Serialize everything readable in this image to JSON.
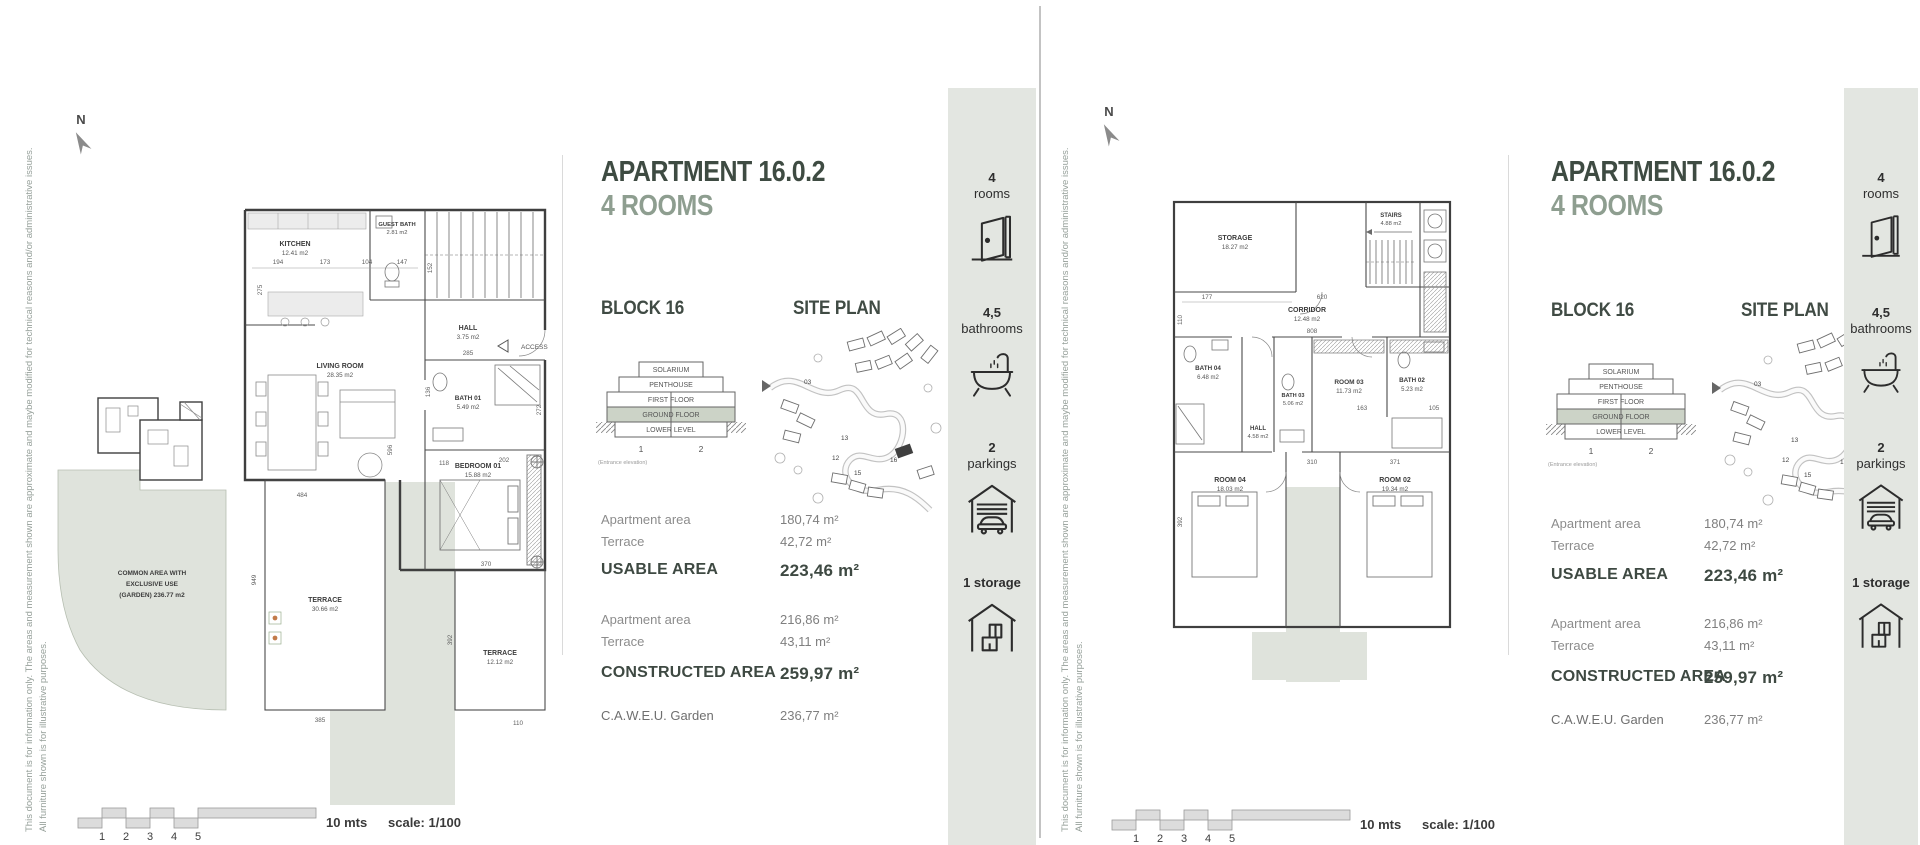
{
  "disclaimer": {
    "line1": "This document is for information only. The areas and measurement shown are approximate and maybe modified for technical reasons and/or administrative issues.",
    "line2": "All furniture shown is for illustrative purposes."
  },
  "compass": {
    "label": "N"
  },
  "title": {
    "name": "APARTMENT 16.0.2",
    "subtitle": "4 ROOMS"
  },
  "block": {
    "heading": "BLOCK 16",
    "levels": [
      "SOLARIUM",
      "PENTHOUSE",
      "FIRST FLOOR",
      "GROUND FLOOR",
      "LOWER LEVEL"
    ],
    "highlighted_level": "GROUND FLOOR",
    "unit1": "1",
    "unit2": "2",
    "note": "(Entrance elevation)"
  },
  "siteplan": {
    "heading": "SITE PLAN",
    "numbers": [
      "03",
      "13",
      "12",
      "15",
      "16"
    ]
  },
  "areas": {
    "row1_label": "Apartment area",
    "row1_value": "180,74 m²",
    "row2_label": "Terrace",
    "row2_value": "42,72 m²",
    "usable_label": "USABLE AREA",
    "usable_value": "223,46 m²",
    "row3_label": "Apartment area",
    "row3_value": "216,86 m²",
    "row4_label": "Terrace",
    "row4_value": "43,11 m²",
    "constructed_label": "CONSTRUCTED AREA",
    "constructed_value": "259,97 m²",
    "garden_label": "C.A.W.E.U. Garden",
    "garden_value": "236,77 m²"
  },
  "sidebar": {
    "items": [
      {
        "line1": "4",
        "line2": "rooms",
        "icon": "door-icon"
      },
      {
        "line1": "4,5",
        "line2": "bathrooms",
        "icon": "bathtub-icon"
      },
      {
        "line1": "2",
        "line2": "parkings",
        "icon": "garage-icon"
      },
      {
        "line1": "1 storage",
        "line2": "",
        "icon": "storage-icon"
      }
    ]
  },
  "scalebar": {
    "ticks": [
      "1",
      "2",
      "3",
      "4",
      "5"
    ],
    "length_label": "10 mts",
    "scale_label": "scale: 1/100"
  },
  "plans": {
    "ground": {
      "rooms": [
        {
          "name": "KITCHEN",
          "area": "12.41 m2"
        },
        {
          "name": "GUEST BATH",
          "area": "2.81 m2"
        },
        {
          "name": "HALL",
          "area": "3.75 m2"
        },
        {
          "name": "LIVING ROOM",
          "area": "28.35 m2"
        },
        {
          "name": "BATH 01",
          "area": "5.49 m2"
        },
        {
          "name": "BEDROOM 01",
          "area": "15.88 m2"
        },
        {
          "name": "TERRACE",
          "area": "30.66 m2"
        },
        {
          "name": "TERRACE",
          "area": "12.12 m2"
        }
      ],
      "common_area_line1": "COMMON AREA WITH",
      "common_area_line2": "EXCLUSIVE USE",
      "common_area_line3": "(GARDEN) 236.77 m2",
      "access_label": "ACCESS",
      "dims": [
        "194",
        "173",
        "104",
        "147",
        "275",
        "152",
        "285",
        "136",
        "596",
        "118",
        "272",
        "202",
        "370",
        "949",
        "484",
        "385",
        "392",
        "110"
      ]
    },
    "upper": {
      "rooms": [
        {
          "name": "STORAGE",
          "area": "18.27 m2"
        },
        {
          "name": "STAIRS",
          "area": "4.88 m2"
        },
        {
          "name": "CORRIDOR",
          "area": "12.48 m2"
        },
        {
          "name": "BATH 04",
          "area": "6.48 m2"
        },
        {
          "name": "BATH 03",
          "area": "5.06 m2"
        },
        {
          "name": "ROOM 03",
          "area": "11.73 m2"
        },
        {
          "name": "BATH 02",
          "area": "5.23 m2"
        },
        {
          "name": "HALL",
          "area": "4.58 m2"
        },
        {
          "name": "ROOM 04",
          "area": "18.03 m2"
        },
        {
          "name": "ROOM 02",
          "area": "19.34 m2"
        }
      ],
      "dims": [
        "177",
        "620",
        "110",
        "808",
        "310",
        "371",
        "105",
        "163",
        "392"
      ]
    }
  }
}
